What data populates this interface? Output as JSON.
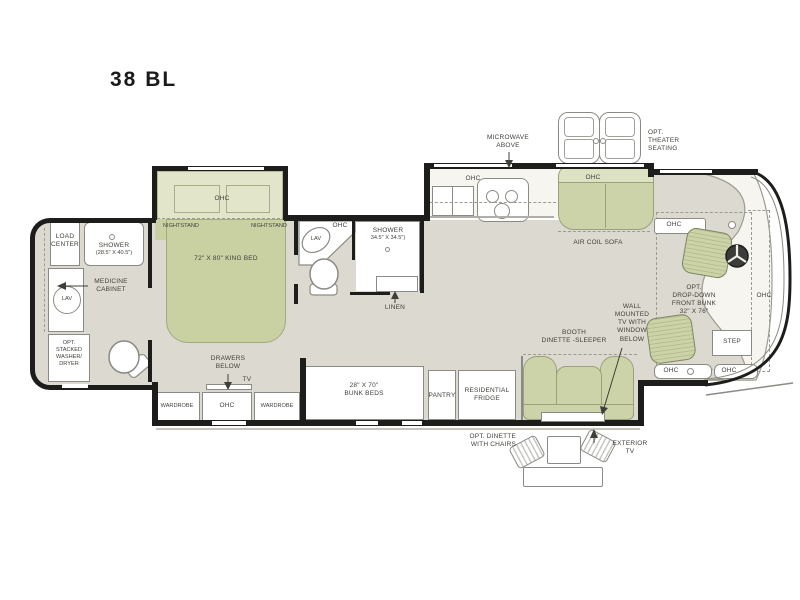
{
  "title": "38 BL",
  "colors": {
    "floor": "#dcd9d0",
    "furniture_green": "#ccd3a8",
    "slide_green": "#e2e5ca",
    "wall": "#1d1d1b",
    "fixture_border": "#8b8b85"
  },
  "labels": {
    "rear_bath": {
      "load_center": "LOAD\nCENTER",
      "shower": "SHOWER",
      "shower_dims": "(28.5\" X 40.5\")",
      "medicine_cabinet": "MEDICINE\nCABINET",
      "lav": "LAV",
      "washer_dryer": "OPT.\nSTACKED\nWASHER/\nDRYER"
    },
    "bedroom": {
      "ohc_overhead": "OHC",
      "nightstand_left": "NIGHTSTAND",
      "nightstand_right": "NIGHTSTAND",
      "king_bed": "72\" X 80\" KING BED",
      "drawers_below": "DRAWERS\nBELOW",
      "tv": "TV",
      "wardrobe_left": "WARDROBE",
      "ohc_dresser": "OHC",
      "wardrobe_right": "WARDROBE"
    },
    "mid_bath": {
      "lav": "LAV",
      "ohc": "OHC",
      "shower": "SHOWER",
      "shower_dims": "34.5\" X 34.5\")",
      "linen": "LINEN"
    },
    "kitchen": {
      "microwave": "MICROWAVE\nABOVE",
      "ohc": "OHC"
    },
    "living": {
      "sofa_ohc": "OHC",
      "air_coil_sofa": "AIR COIL SOFA",
      "booth_dinette": "BOOTH\nDINETTE -SLEEPER",
      "wall_tv": "WALL\nMOUNTED\nTV WITH\nWINDOW\nBELOW",
      "bunk_beds": "28\" X 70\"\nBUNK BEDS",
      "pantry": "PANTRY",
      "fridge": "RESIDENTIAL\nFRIDGE"
    },
    "front": {
      "ohc_top": "OHC",
      "bunk": "OPT.\nDROP-DOWN\nFRONT BUNK\n32\" X 76\"",
      "ohc_right": "OHC",
      "step": "STEP",
      "ohc_bottom_left": "OHC",
      "ohc_bottom_right": "OHC"
    },
    "exterior": {
      "theater": "OPT.\nTHEATER\nSEATING",
      "dinette": "OPT. DINETTE\nWITH CHAIRS",
      "exterior_tv": "EXTERIOR\nTV"
    }
  }
}
